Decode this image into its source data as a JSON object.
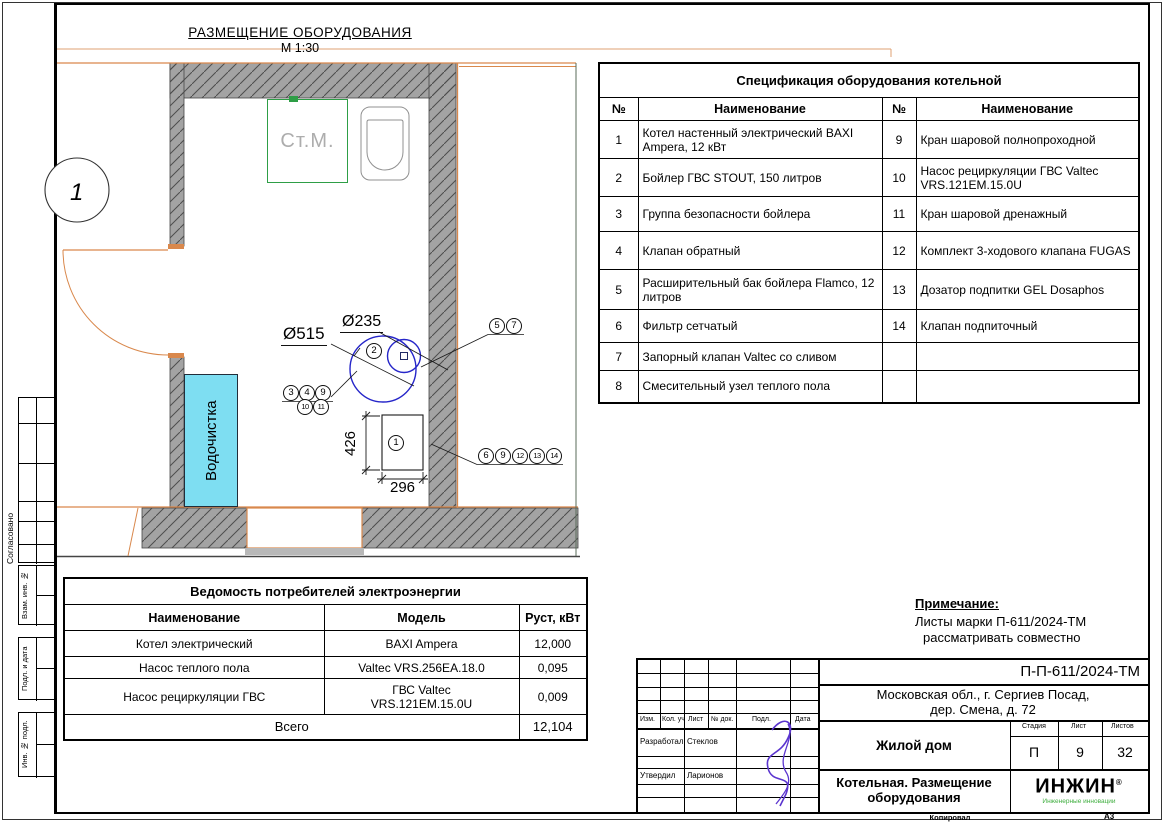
{
  "drawing": {
    "title": "РАЗМЕЩЕНИЕ ОБОРУДОВАНИЯ",
    "scale": "М 1:30"
  },
  "plan": {
    "machine_label": "Ст.М.",
    "water_treatment_label": "Водочистка",
    "axis_label": "1",
    "dims": {
      "dia_large": "Ø515",
      "dia_small": "Ø235",
      "height": "426",
      "width": "296"
    },
    "callouts": {
      "c2": "2",
      "c5": "5",
      "c7": "7",
      "c3": "3",
      "c4": "4",
      "c9": "9",
      "c10": "10",
      "c11": "11",
      "c1": "1",
      "g6": "6",
      "g9": "9",
      "g12": "12",
      "g13": "13",
      "g14": "14"
    }
  },
  "spec_table": {
    "title": "Спецификация оборудования котельной",
    "headers": [
      "№",
      "Наименование",
      "№",
      "Наименование"
    ],
    "rows": [
      {
        "n1": "1",
        "name1": "Котел настенный электрический BAXI Ampera, 12 кВт",
        "n2": "9",
        "name2": "Кран шаровой полнопроходной"
      },
      {
        "n1": "2",
        "name1": "Бойлер ГВС STOUT, 150 литров",
        "n2": "10",
        "name2": "Насос рециркуляции ГВС Valtec VRS.121EM.15.0U"
      },
      {
        "n1": "3",
        "name1": "Группа безопасности бойлера",
        "n2": "11",
        "name2": "Кран шаровой дренажный"
      },
      {
        "n1": "4",
        "name1": "Клапан обратный",
        "n2": "12",
        "name2": "Комплект 3-ходового клапана FUGAS"
      },
      {
        "n1": "5",
        "name1": "Расширительный бак бойлера Flamco, 12 литров",
        "n2": "13",
        "name2": "Дозатор подпитки GEL Dosaphos"
      },
      {
        "n1": "6",
        "name1": "Фильтр сетчатый",
        "n2": "14",
        "name2": "Клапан подпиточный"
      },
      {
        "n1": "7",
        "name1": "Запорный клапан Valtec со сливом",
        "n2": "",
        "name2": ""
      },
      {
        "n1": "8",
        "name1": "Смесительный узел теплого пола",
        "n2": "",
        "name2": ""
      }
    ]
  },
  "consumers_table": {
    "title": "Ведомость потребителей электроэнергии",
    "headers": [
      "Наименование",
      "Модель",
      "Руст, кВт"
    ],
    "rows": [
      {
        "name": "Котел электрический",
        "model": "BAXI Ampera",
        "model2": "",
        "power": "12,000"
      },
      {
        "name": "Насос теплого пола",
        "model": "Valtec VRS.256EA.18.0",
        "model2": "",
        "power": "0,095"
      },
      {
        "name": "Насос рециркуляции ГВС",
        "model": "ГВС  Valtec",
        "model2": "VRS.121EM.15.0U",
        "power": "0,009"
      }
    ],
    "total_label": "Всего",
    "total_value": "12,104"
  },
  "note": {
    "title": "Примечание:",
    "line1": "Листы марки П-611/2024-ТМ",
    "line2": "рассматривать совместно"
  },
  "title_block": {
    "doc_number": "П-П-611/2024-ТМ",
    "address_line1": "Московская обл., г. Сергиев Посад,",
    "address_line2": "дер. Смена, д. 72",
    "object_name": "Жилой дом",
    "sheet_title_line1": "Котельная. Размещение",
    "sheet_title_line2": "оборудования",
    "stage_label": "Стадия",
    "stage_value": "П",
    "sheet_label": "Лист",
    "sheet_value": "9",
    "sheets_label": "Листов",
    "sheets_value": "32",
    "col_izm": "Изм.",
    "col_kol": "Кол. уч",
    "col_list": "Лист",
    "col_doc": "№ док.",
    "col_podp": "Подл.",
    "col_date": "Дата",
    "developed_label": "Разработал",
    "developed_name": "Стеклов",
    "approved_label": "Утвердил",
    "approved_name": "Ларионов",
    "logo_text": "ИНЖИН",
    "logo_reg": "®",
    "logo_sub": "Инженерные инновации",
    "copied_label": "Копировал",
    "format_label": "А3"
  },
  "sidebar": {
    "agreed": "Согласовано",
    "inv_replace": "Взам. инв. №",
    "sig_date": "Подл. и дата",
    "inv_orig": "Инв. № подл."
  },
  "colors": {
    "wall_gray": "#a3a3a3",
    "line_orange": "#d9884c",
    "water_cyan": "#7edef2",
    "machine_green": "#2e9e46",
    "circle_blue": "#2626c9",
    "logo_green": "#3fae3f",
    "signature_purple": "#5b35cf"
  }
}
